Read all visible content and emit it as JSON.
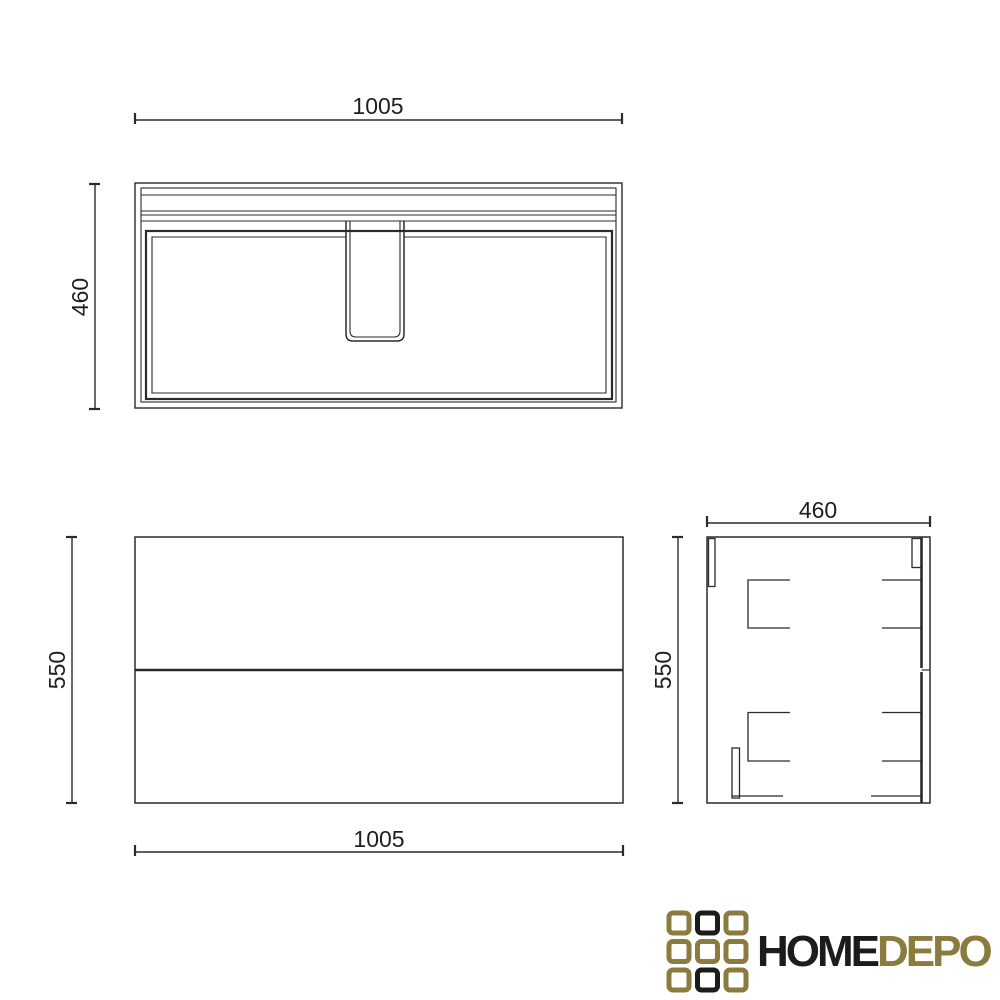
{
  "colors": {
    "background": "#ffffff",
    "line": "#2b2b2b",
    "text": "#1f1f1f",
    "logo_black": "#1c1c1c",
    "logo_gold": "#8c7b3e"
  },
  "views": {
    "top": {
      "width_label": "1005",
      "depth_label": "460"
    },
    "front": {
      "height_label": "550",
      "width_label": "1005"
    },
    "side": {
      "width_label": "460",
      "height_label": "550"
    }
  },
  "logo": {
    "text_primary": "HOME",
    "text_secondary": "DEPO"
  }
}
